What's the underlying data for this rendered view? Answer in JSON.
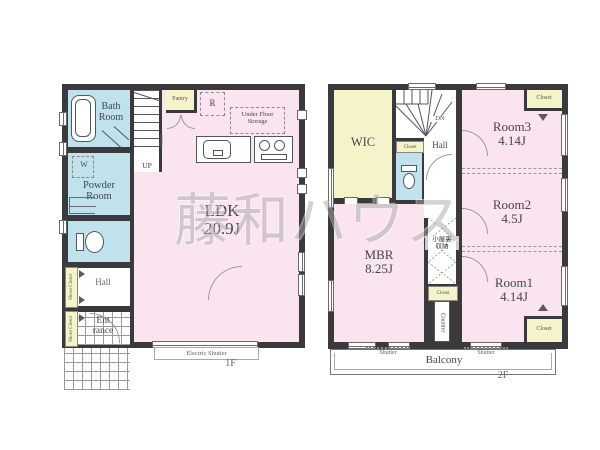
{
  "watermark": "藤和ハウス",
  "colors": {
    "wall": "#3a3a3c",
    "room_pink": "#f9e4ef",
    "room_blue": "#bfe2ed",
    "room_yellow": "#f5f3c9",
    "watermark_gray": "#a9a9a9"
  },
  "floor1": {
    "name": "1F",
    "labels": {
      "bath_room": "Bath\nRoom",
      "washer": "W",
      "powder_room": "Powder\nRoom",
      "hall": "Hall",
      "entrance": "Ent\nrance",
      "shoes_closet_1": "Shoes Closet",
      "shoes_closet_2": "Shoes Closet",
      "up": "UP",
      "niche": "Niche",
      "pantry": "Pantry",
      "refrigerator": "R",
      "under_floor_storage": "Under Floor\nStorage",
      "ldk": "LDK\n20.9J",
      "electric_shutter": "Electric Shutter"
    }
  },
  "floor2": {
    "name": "2F",
    "labels": {
      "wic": "WIC",
      "dn": "DN",
      "hall": "Hall",
      "hall_closet": "Closet",
      "room3": "Room3\n4.14J",
      "room3_closet": "Closet",
      "room2": "Room2\n4.5J",
      "room1": "Room1\n4.14J",
      "room1_closet": "Closet",
      "mbr": "MBR\n8.25J",
      "attic_storage": "小屋裏\n収納",
      "mid_closet": "Closet",
      "counter": "Counter",
      "balcony": "Balcony",
      "shutter_left": "Shutter",
      "shutter_right": "Shutter"
    }
  }
}
